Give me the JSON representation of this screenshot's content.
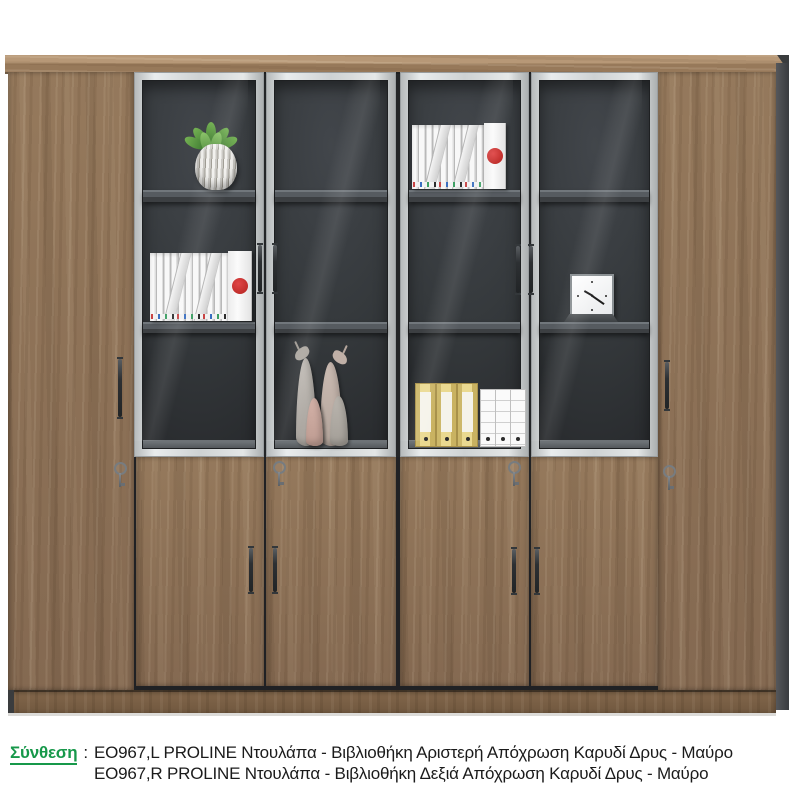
{
  "caption": {
    "label": "Σύνθεση",
    "separator": ":",
    "line1": "EO967,L PROLINE Ντουλάπα - Βιβλιοθήκη Αριστερή Απόχρωση Καρυδί Δρυς - Μαύρο",
    "line2": "EO967,R PROLINE Ντουλάπα - Βιβλιοθήκη Δεξιά Απόχρωση Καρυδί Δρυς - Μαύρο",
    "label_color": "#17984a",
    "text_color": "#1b1b1b"
  },
  "cabinet": {
    "colors": {
      "wood": "#8d7053",
      "wood_top": "#ab8c68",
      "plinth": "#765c42",
      "aluminium_frame": "#ced2d3",
      "interior_dark": "#34383b",
      "shelf_gray": "#565b60",
      "side_panel_dark": "#44464a"
    },
    "decor_items": [
      {
        "name": "succulent-plant",
        "location": "glass-column-1-top-shelf"
      },
      {
        "name": "white-binders-red-dot",
        "location": "glass-column-1-middle-shelf"
      },
      {
        "name": "deer-figurines",
        "location": "glass-column-2-bottom-shelf"
      },
      {
        "name": "white-binders-red-dot",
        "location": "glass-column-3-top-shelf"
      },
      {
        "name": "yellow-and-white-lever-files",
        "location": "glass-column-3-bottom-shelf"
      },
      {
        "name": "square-desk-clock",
        "location": "glass-column-4-middle-shelf"
      }
    ]
  }
}
